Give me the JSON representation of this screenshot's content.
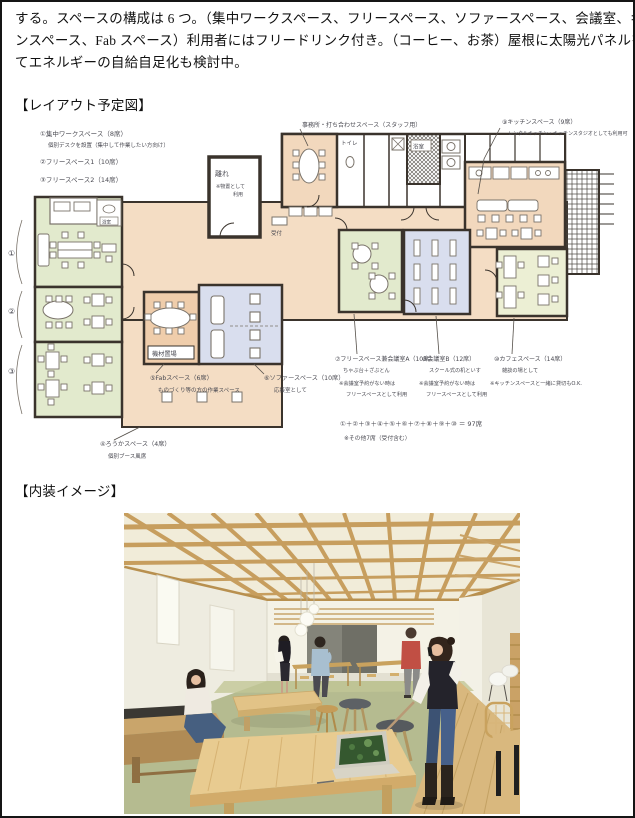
{
  "document": {
    "body_text": {
      "line1": "する。スペースの構成は 6 つ。（集中ワークスペース、フリースペース、ソファースペース、会議室、キッチ",
      "line2": "ンスペース、Fab スペース）利用者にはフリードリンク付き。（コーヒー、お茶）屋根に太陽光パネルを載せ",
      "line3": "てエネルギーの自給自足化も検討中。"
    },
    "headings": {
      "layout": "【レイアウト予定図】",
      "interior": "【内装イメージ】"
    }
  },
  "plan": {
    "notes": {
      "n1a": "①集中ワークスペース（8席）",
      "n1b": "個別デスクを設置（集中して作業したい方向け）",
      "n2": "②フリースペース1（10席）",
      "n3": "③フリースペース2（14席）",
      "office": "事務所・打ち合わせスペース（スタッフ用）",
      "n9a": "⑨キッチンスペース（9席）",
      "n9b": "レンタルキッチン・キッチンスタジオとしても利用可",
      "hanare1": "離れ",
      "hanare2": "※物置として",
      "hanare3": "利用",
      "kizai": "機材置場",
      "n5a": "⑤Fabスペース（6席）",
      "n5b": "ものづくり等の方の作業スペース",
      "n6a": "⑥ソファースペース（10席）",
      "n6b": "応接室として",
      "n4a": "④ろうかスペース（4席）",
      "n4b": "個別ブース風席",
      "n7a": "⑦フリースペース兼会議室A（10席）",
      "n7b": "ちゃぶ台＋ざぶとん",
      "n7c": "※会議室予約がない時は",
      "n7d": "フリースペースとして利用",
      "n8a": "⑧会議室B（12席）",
      "n8b": "スクール式の机といす",
      "n8c": "※会議室予約がない時は",
      "n8d": "フリースペースとして利用",
      "n10a": "⑩カフェスペース（14席）",
      "n10b": "雑談の場として",
      "n10c": "※キッチンスペースと一緒に貸切もO.K.",
      "total1": "①＋②＋③＋④＋⑤＋⑥＋⑦＋⑧＋⑨＋⑩ ＝ 97席",
      "total2": "※その他7席（受付含む）",
      "toilet": "トイレ",
      "bath": "浴室",
      "bath_small": "浴室",
      "reception": "受付",
      "side1": "①",
      "side2": "②",
      "side3": "③"
    }
  },
  "colors": {
    "plan_wall": "#3a332c",
    "plan_tan": "#f4ddc4",
    "plan_green": "#e2eacd",
    "plan_blue": "#d9deee",
    "render_wood": "#c79e5e",
    "render_floor_green": "#b5bb90",
    "accent_red_shirt": "#c14f44"
  }
}
